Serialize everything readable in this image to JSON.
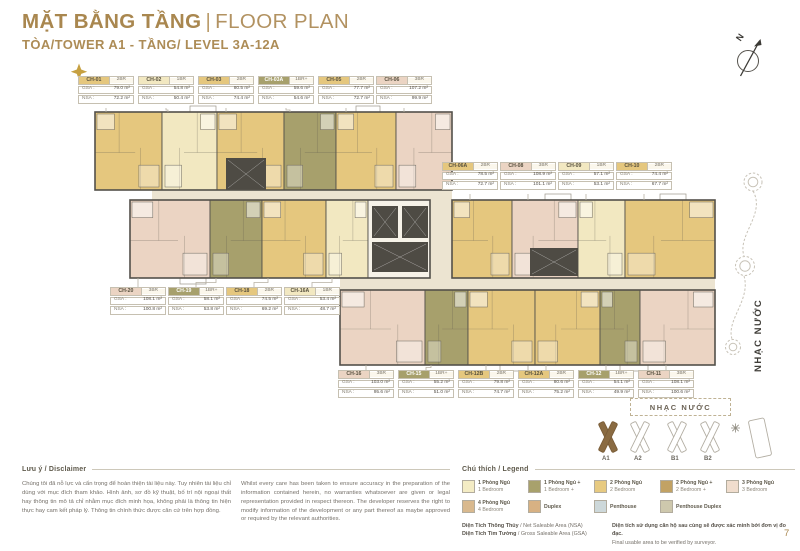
{
  "page": {
    "page_number": "7"
  },
  "header": {
    "title_vi": "MẶT BẰNG TẦNG",
    "title_sep": "|",
    "title_en": "FLOOR PLAN",
    "subtitle": "TÒA/TOWER A1 - TẦNG/ LEVEL 3A-12A",
    "accent_color": "#a9874f"
  },
  "compass": {
    "label": "N"
  },
  "info_labels": {
    "gsa": "GSA :",
    "nsa": "NSA :"
  },
  "unit_types": {
    "1BR": {
      "color": "#f2e8c1"
    },
    "1BR+": {
      "color": "#a7a06c"
    },
    "2BR": {
      "color": "#e5c77e"
    },
    "2BR+": {
      "color": "#c2a264"
    },
    "3BR": {
      "color": "#ebd4c3"
    }
  },
  "units": [
    {
      "id": "CH-01",
      "type": "2BR",
      "gsa": "79.0 m²",
      "nsa": "72.2 m²"
    },
    {
      "id": "CH-02",
      "type": "1BR",
      "gsa": "54.8 m²",
      "nsa": "50.4 m²"
    },
    {
      "id": "CH-03",
      "type": "2BR",
      "gsa": "80.5 m²",
      "nsa": "74.4 m²"
    },
    {
      "id": "CH-03A",
      "type": "1BR+",
      "gsa": "59.6 m²",
      "nsa": "54.6 m²"
    },
    {
      "id": "CH-05",
      "type": "2BR",
      "gsa": "77.7 m²",
      "nsa": "72.7 m²"
    },
    {
      "id": "CH-06",
      "type": "3BR",
      "gsa": "107.2 m²",
      "nsa": "99.9 m²"
    },
    {
      "id": "CH-06A",
      "type": "2BR",
      "gsa": "78.5 m²",
      "nsa": "72.7 m²"
    },
    {
      "id": "CH-08",
      "type": "3BR",
      "gsa": "108.9 m²",
      "nsa": "101.1 m²"
    },
    {
      "id": "CH-09",
      "type": "1BR",
      "gsa": "57.1 m²",
      "nsa": "53.1 m²"
    },
    {
      "id": "CH-10",
      "type": "2BR",
      "gsa": "74.4 m²",
      "nsa": "67.7 m²"
    },
    {
      "id": "CH-20",
      "type": "3BR",
      "gsa": "108.1 m²",
      "nsa": "100.8 m²"
    },
    {
      "id": "CH-19",
      "type": "1BR+",
      "gsa": "58.1 m²",
      "nsa": "53.8 m²"
    },
    {
      "id": "CH-18",
      "type": "2BR",
      "gsa": "74.5 m²",
      "nsa": "69.2 m²"
    },
    {
      "id": "CH-16A",
      "type": "1BR",
      "gsa": "53.4 m²",
      "nsa": "48.7 m²"
    },
    {
      "id": "CH-16",
      "type": "3BR",
      "gsa": "103.0 m²",
      "nsa": "95.6 m²"
    },
    {
      "id": "CH-15",
      "type": "1BR+",
      "gsa": "55.2 m²",
      "nsa": "51.0 m²"
    },
    {
      "id": "CH-12B",
      "type": "2BR",
      "gsa": "79.8 m²",
      "nsa": "74.7 m²"
    },
    {
      "id": "CH-12A",
      "type": "2BR",
      "gsa": "80.6 m²",
      "nsa": "75.2 m²"
    },
    {
      "id": "CH-12",
      "type": "1BR+",
      "gsa": "54.1 m²",
      "nsa": "49.9 m²"
    },
    {
      "id": "CH-11",
      "type": "3BR",
      "gsa": "108.1 m²",
      "nsa": "100.6 m²"
    }
  ],
  "plan_colors": {
    "corridor": "#ece4d1",
    "wall": "#53504a",
    "core": "#4e4b44",
    "service": "#f6f2e8"
  },
  "fountain": {
    "label": "NHẠC NƯỚC"
  },
  "site_map": {
    "label": "NHẠC NƯỚC",
    "towers": [
      "A1",
      "A2",
      "B1",
      "B2"
    ],
    "highlight": "A1",
    "highlight_color": "#8a6b42"
  },
  "legend": {
    "heading": "Chú thích / Legend",
    "items": [
      {
        "vi": "1 Phòng Ngủ",
        "en": "1 Bedroom",
        "color": "#f4ecc4"
      },
      {
        "vi": "1 Phòng Ngủ +",
        "en": "1 Bedroom +",
        "color": "#a8a16c"
      },
      {
        "vi": "2 Phòng Ngủ",
        "en": "2 Bedroom",
        "color": "#e7ca81"
      },
      {
        "vi": "2 Phòng Ngủ +",
        "en": "2 Bedroom +",
        "color": "#c2a264"
      },
      {
        "vi": "3 Phòng Ngủ",
        "en": "3 Bedroom",
        "color": "#f0ddcd"
      },
      {
        "vi": "4 Phòng Ngủ",
        "en": "4 Bedroom",
        "color": "#d9b98e"
      },
      {
        "vi": "Duplex",
        "en": "",
        "color": "#d7b183"
      },
      {
        "vi": "Penthouse",
        "en": "",
        "color": "#cdd8da"
      },
      {
        "vi": "Penthouse Duplex",
        "en": "",
        "color": "#cec8ad"
      }
    ]
  },
  "notes": {
    "nsa_vi": "Diện Tích Thông Thủy",
    "nsa_en": " / Net Saleable Area (NSA)",
    "gsa_vi": "Diện Tích Tim Tường",
    "gsa_en": " / Gross Saleable Area (GSA)",
    "verify_vi": "Diện tích sử dụng căn hộ sau cùng sẽ được xác minh bởi đơn vị đo đạc.",
    "verify_en": "Final usable area to be verified by surveyor."
  },
  "disclaimer": {
    "heading": "Lưu ý / Disclaimer",
    "vi": "Chúng tôi đã nỗ lực và cẩn trọng để hoàn thiện tài liệu này. Tuy nhiên tài liệu chỉ dùng với mục đích tham khảo. Hình ảnh, sơ đồ kỹ thuật, bố trí nội ngoại thất hay thông tin mô tả chỉ nhằm mục đích minh họa, không phải là thông tin hiện thực hay cam kết pháp lý. Thông tin chính thức được căn cứ trên hợp đồng.",
    "en": "Whilst every care has been taken to ensure accuracy in the preparation of the information contained herein, no warranties whatsoever are given or legal representation provided in respect thereon. The developer reserves the right to modify information of the development or any part thereof as maybe approved or required by the relevant authorities."
  }
}
